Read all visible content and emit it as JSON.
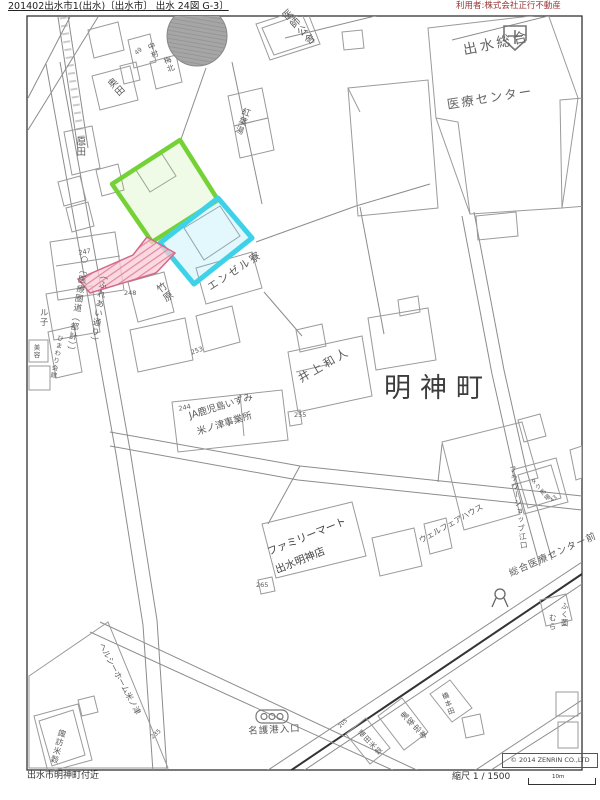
{
  "header": {
    "left": "201402出水市1(出水)〔出水市〕 出水 24図 G-3〕",
    "right": "利用者:株式会社正行不動産"
  },
  "footer": {
    "area": "出水市明神町付近",
    "scale": "縮尺 1 / 1500",
    "scale_unit": "10m",
    "copyright": "© 2014 ZENRIN CO.,LTD"
  },
  "colors": {
    "green_parcel": "#74d236",
    "cyan_parcel": "#3ed2e8",
    "pink_strip": "#e2879f",
    "header_right_red": "#993333"
  },
  "map": {
    "labels": {
      "street_official": "○〔医療圏道（都計）〕",
      "street_common": "（ふれあい通り）",
      "doctor_housing": "医師公舎",
      "hospital_name_1": "出水総合",
      "hospital_name_2": "医療センター",
      "nakamura": "中村",
      "umekita": "梅北",
      "num_49": "49",
      "okuda": "奥田",
      "harada": "原田",
      "koyo_bath": "紅葉湯",
      "num_247": "247",
      "num_248": "248",
      "takehara": "竹原",
      "angel_dorm": "エンゼル寮",
      "ruko": "ル子",
      "himawari": "ひまわり会館",
      "biyo": "美容",
      "inoue": "井上和人",
      "myojincho": "明神町",
      "num_244": "244",
      "ja_1": "JA鹿児島いずみ",
      "ja_2": "米ノ津事業所",
      "num_253": "253",
      "num_255": "255",
      "famima_1": "ファミリーマート",
      "famima_2": "出水明神店",
      "num_265": "265",
      "flower_shop": "フラワーショップ江口",
      "baba": "タク馬場",
      "num_43": "43",
      "welfare_house": "ウェルフェアハウス",
      "bus_stop": "総合医療センター前",
      "fukuzono": "ふく薗",
      "mura": "むら",
      "nago_port": "名護港入口",
      "healthy_home": "ヘルシーホーム米ノ津",
      "num_235": "235",
      "suwa": "諏訪米穀",
      "onizuka": "鬼塚忠孝",
      "fukuda": "福田米穀",
      "num_205": "205",
      "hashimoto": "橋本田"
    }
  }
}
